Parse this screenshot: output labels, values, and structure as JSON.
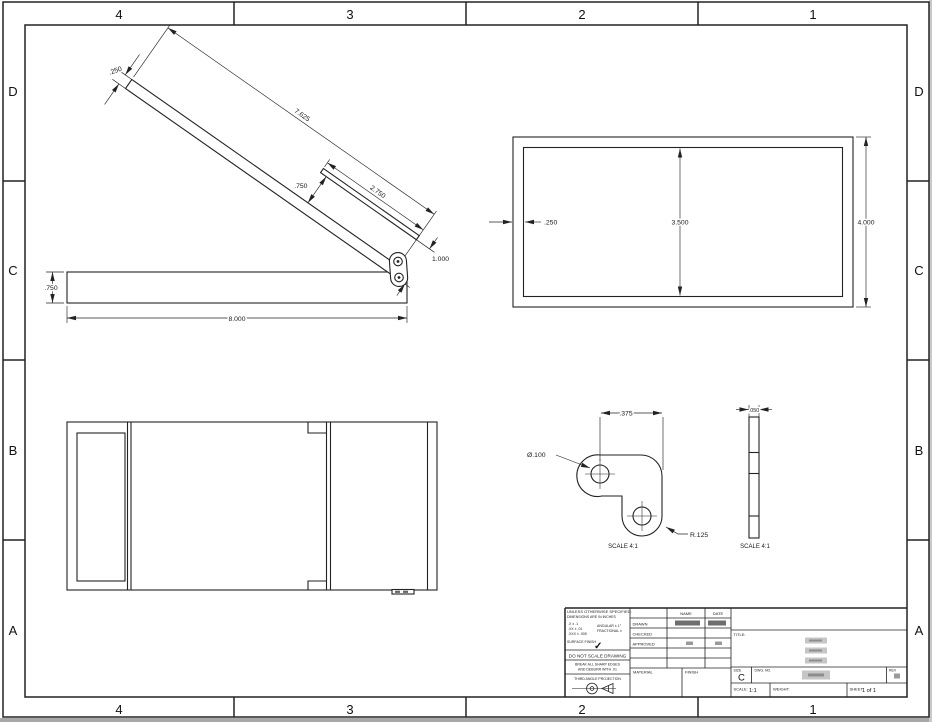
{
  "sheet": {
    "zone_columns": [
      "4",
      "3",
      "2",
      "1"
    ],
    "zone_rows": [
      "D",
      "C",
      "B",
      "A"
    ]
  },
  "views": {
    "side": {
      "lid_length": "7.625",
      "lid_thickness": ".250",
      "hinge_gap": ".750",
      "support_length": "2.750",
      "end_width": "1.000",
      "base_length": "8.000",
      "base_height": ".750"
    },
    "front": {
      "wall_thickness": ".250",
      "inner_height": "3.500",
      "outer_height": "4.000"
    },
    "bracket_detail": {
      "hole_offset": ".375",
      "hole_diameter": "Ø.100",
      "corner_radius": "R.125",
      "scale": "SCALE 4:1"
    },
    "bracket_side_detail": {
      "thickness": ".050",
      "scale": "SCALE 4:1"
    }
  },
  "title_block": {
    "notes": {
      "line1": "UNLESS OTHERWISE SPECIFIED:",
      "line2": "DIMENSIONS ARE IN INCHES",
      "tol1": ".X ± .1",
      "tol2": ".XX ± .01",
      "tol3": ".XXX ± .005",
      "tol4": "ANGULAR ± 1°",
      "tol5": "FRACTIONAL ±",
      "surface": "SURFACE FINISH",
      "check": "✓"
    },
    "do_not_scale": "DO NOT SCALE DRAWING",
    "deburr1": "BREAK ALL SHARP EDGES",
    "deburr2": "AND DEBURR WITH .01",
    "projection": "THIRD ANGLE PROJECTION",
    "material_label": "MATERIAL",
    "finish_label": "FINISH",
    "name_header": "NAME",
    "date_header": "DATE",
    "row_drawn": "DRAWN",
    "row_checked": "CHECKED",
    "row_approved": "APPROVED",
    "title_label": "TITLE:",
    "size_label": "SIZE",
    "size_value": "C",
    "dwg_label": "DWG. NO.",
    "rev_label": "REV",
    "scale_label": "SCALE:",
    "scale_value": "1:1",
    "weight_label": "WEIGHT:",
    "sheet_label": "SHEET",
    "sheet_value": "1 of 1"
  }
}
